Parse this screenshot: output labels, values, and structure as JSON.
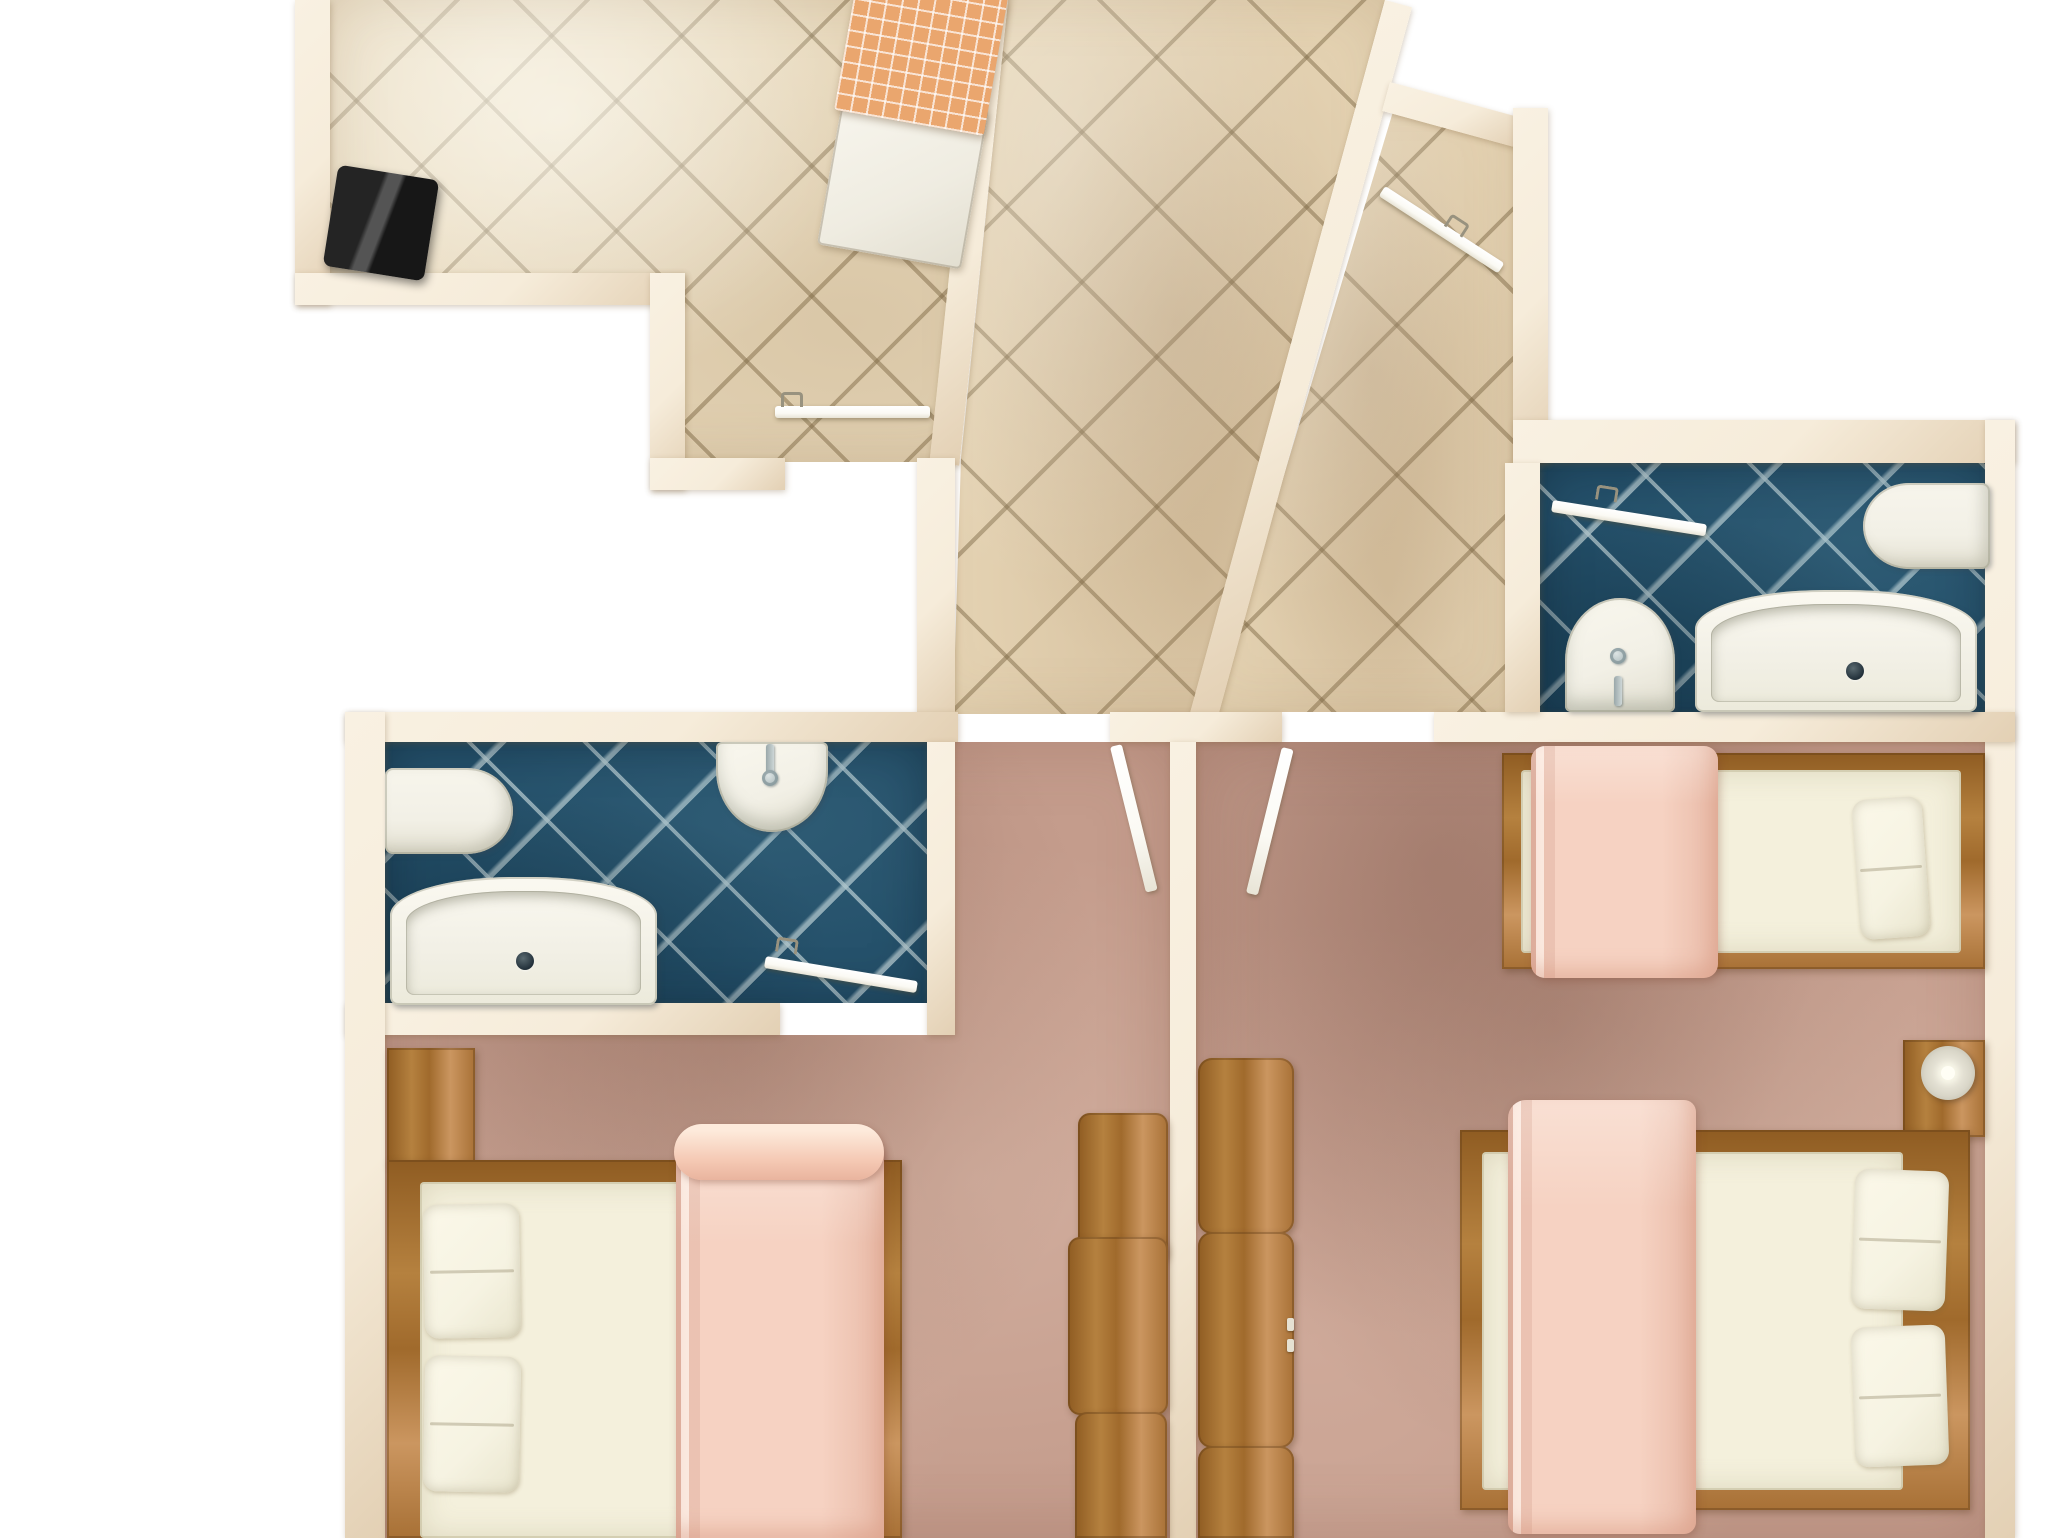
{
  "title": "apartment-floor-plan-top-view",
  "colors": {
    "background": "#ffffff",
    "wall": "#f6ecda",
    "wallEdge": "#e3d0b4",
    "tileBeige": "#e6d6b8",
    "tileLarge": "#e4d2b2",
    "tealTile": "#24506a",
    "carpet": "#c49c8c",
    "wood": "#b5813f",
    "woodDark": "#8f5c22",
    "woodLight": "#cb9660",
    "fixture": "#f2f0e6",
    "mattress": "#f4f0dc",
    "pillow": "#f6f3e2",
    "blanket": "#f6d2c2",
    "blanketDeep": "#e9b49e",
    "doorWhite": "#fbfaf4",
    "lamp": "#d9d6c8",
    "orange": "#eaa66e",
    "black": "#171717"
  },
  "rooms": [
    {
      "name": "dining-room",
      "floor": "beige-diagonal-tile"
    },
    {
      "name": "hallway",
      "floor": "beige-diagonal-tile-large"
    },
    {
      "name": "entry-branch",
      "floor": "beige-diagonal-tile-large"
    },
    {
      "name": "bathroom-left",
      "floor": "teal-diagonal-tile"
    },
    {
      "name": "bathroom-right",
      "floor": "teal-diagonal-tile"
    },
    {
      "name": "bedroom-left",
      "floor": "rose-carpet"
    },
    {
      "name": "bedroom-right",
      "floor": "rose-carpet"
    }
  ],
  "scene": [
    {
      "n": "floor-dining-room",
      "k": "tilesS",
      "x": 330,
      "y": 0,
      "w": 650,
      "h": 462,
      "clip": "polygon(0px 0px, 648px 0px, 600px 462px, 320px 462px, 320px 273px, 0px 273px)"
    },
    {
      "n": "dining-room-light",
      "k": "shadeLight",
      "x": 330,
      "y": 0,
      "w": 650,
      "h": 462,
      "clip": "polygon(0px 0px, 648px 0px, 600px 462px, 320px 462px, 320px 273px, 0px 273px)"
    },
    {
      "n": "floor-hallway",
      "k": "tilesL",
      "x": 917,
      "y": 0,
      "w": 470,
      "h": 714,
      "clip": "polygon(91px 0px, 468px 0px, 273px 714px, 36px 714px, 44px 458px)"
    },
    {
      "n": "hallway-shade",
      "k": "shadeWarm",
      "x": 917,
      "y": 0,
      "w": 470,
      "h": 714,
      "clip": "polygon(91px 0px, 468px 0px, 273px 714px, 36px 714px, 44px 458px)"
    },
    {
      "n": "floor-entry-branch",
      "k": "tilesL",
      "x": 1190,
      "y": 85,
      "w": 330,
      "h": 630,
      "clip": "polygon(208px 10px, 330px 43px, 325px 627px, 23px 627px)"
    },
    {
      "n": "entry-branch-shade",
      "k": "shadeWarm",
      "x": 1190,
      "y": 85,
      "w": 330,
      "h": 630,
      "clip": "polygon(208px 10px, 330px 43px, 325px 627px, 23px 627px)"
    },
    {
      "n": "floor-bathroom-right",
      "k": "tilesT",
      "x": 1540,
      "y": 463,
      "w": 450,
      "h": 252
    },
    {
      "n": "floor-bathroom-left",
      "k": "tilesT",
      "x": 385,
      "y": 742,
      "w": 542,
      "h": 261
    },
    {
      "n": "floor-bedroom-left",
      "k": "carpet",
      "x": 385,
      "y": 742,
      "w": 785,
      "h": 796,
      "clip": "polygon(570px 0px, 785px 0px, 785px 796px, 0px 796px, 0px 293px, 570px 293px)"
    },
    {
      "n": "bedroom-left-shade",
      "k": "shadeDark",
      "x": 385,
      "y": 742,
      "w": 785,
      "h": 796,
      "clip": "polygon(570px 0px, 785px 0px, 785px 796px, 0px 796px, 0px 293px, 570px 293px)"
    },
    {
      "n": "floor-bedroom-right",
      "k": "carpet",
      "x": 1196,
      "y": 742,
      "w": 794,
      "h": 796
    },
    {
      "n": "bedroom-right-shade",
      "k": "shadeDark",
      "x": 1196,
      "y": 742,
      "w": 794,
      "h": 796
    },
    {
      "n": "wall-dining-left",
      "k": "wall",
      "x": 295,
      "y": 0,
      "w": 35,
      "h": 305
    },
    {
      "n": "wall-dining-bottom",
      "k": "wall",
      "x": 295,
      "y": 273,
      "w": 390,
      "h": 32
    },
    {
      "n": "wall-dining-step",
      "k": "wall",
      "x": 650,
      "y": 273,
      "w": 35,
      "h": 217
    },
    {
      "n": "wall-dining-bottom-2",
      "k": "wall",
      "x": 650,
      "y": 458,
      "w": 135,
      "h": 32
    },
    {
      "n": "wall-dining-right",
      "k": "wall",
      "x": 978,
      "y": 0,
      "w": 30,
      "h": 465,
      "r": 6,
      "o": "0 0"
    },
    {
      "n": "wall-hallway-right",
      "k": "wall",
      "x": 1385,
      "y": 0,
      "w": 28,
      "h": 738,
      "r": 15.3,
      "o": "0 0"
    },
    {
      "n": "wall-entry-top",
      "k": "wall",
      "x": 1390,
      "y": 82,
      "w": 140,
      "h": 30,
      "r": 15.3,
      "o": "0 0"
    },
    {
      "n": "wall-entry-right",
      "k": "wall",
      "x": 1513,
      "y": 108,
      "w": 35,
      "h": 355
    },
    {
      "n": "wall-bathroom-right-top",
      "k": "wall",
      "x": 1513,
      "y": 420,
      "w": 502,
      "h": 43
    },
    {
      "n": "wall-outer-right",
      "k": "wall",
      "x": 1985,
      "y": 420,
      "w": 30,
      "h": 1118
    },
    {
      "n": "wall-hallway-left-strip",
      "k": "wall",
      "x": 917,
      "y": 458,
      "w": 38,
      "h": 256
    },
    {
      "n": "wall-main-a",
      "k": "wall",
      "x": 345,
      "y": 712,
      "w": 613,
      "h": 30
    },
    {
      "n": "wall-main-b",
      "k": "wall",
      "x": 1110,
      "y": 712,
      "w": 172,
      "h": 30
    },
    {
      "n": "wall-main-c",
      "k": "wall",
      "x": 1434,
      "y": 712,
      "w": 581,
      "h": 30
    },
    {
      "n": "wall-center-divider",
      "k": "wall",
      "x": 1170,
      "y": 742,
      "w": 26,
      "h": 796
    },
    {
      "n": "wall-bathroom-left-right",
      "k": "wall",
      "x": 927,
      "y": 742,
      "w": 28,
      "h": 293
    },
    {
      "n": "wall-bathroom-left-bottom",
      "k": "wall",
      "x": 345,
      "y": 1003,
      "w": 435,
      "h": 32
    },
    {
      "n": "wall-outer-left",
      "k": "wall",
      "x": 345,
      "y": 712,
      "w": 40,
      "h": 826
    },
    {
      "n": "wall-bathroom-right-left",
      "k": "wall",
      "x": 1505,
      "y": 463,
      "w": 35,
      "h": 249
    },
    {
      "n": "toilet-left-bathroom",
      "k": "fixture",
      "x": 385,
      "y": 768,
      "w": 128,
      "h": 86,
      "rad": "8px 46px 46px 8px / 8px 43px 43px 8px"
    },
    {
      "n": "sink-left-bathroom",
      "k": "sink",
      "x": 716,
      "y": 742,
      "w": 112,
      "h": 90,
      "rad": "6px 6px 56px 56px / 6px 6px 62px 62px"
    },
    {
      "n": "faucet-stem-left",
      "k": "stem",
      "x": 766,
      "y": 744,
      "w": 8,
      "h": 30
    },
    {
      "n": "faucet-knob-left",
      "k": "knob",
      "x": 762,
      "y": 770,
      "w": 16,
      "h": 16
    },
    {
      "n": "bathtub-left",
      "k": "tub",
      "x": 390,
      "y": 877,
      "w": 267,
      "h": 128,
      "rad": "46% 46% 8px 8px / 30% 30% 8px 8px"
    },
    {
      "n": "drain-left",
      "k": "drain",
      "x": 516,
      "y": 952,
      "w": 18,
      "h": 18
    },
    {
      "n": "toilet-right-bathroom",
      "k": "fixture",
      "x": 1863,
      "y": 483,
      "w": 127,
      "h": 86,
      "rad": "46px 8px 8px 46px / 43px 8px 8px 43px"
    },
    {
      "n": "sink-right-bathroom",
      "k": "sink",
      "x": 1565,
      "y": 598,
      "w": 110,
      "h": 114,
      "rad": "56px 56px 6px 6px / 64px 64px 6px 6px"
    },
    {
      "n": "faucet-stem-right",
      "k": "stem",
      "x": 1614,
      "y": 676,
      "w": 8,
      "h": 30
    },
    {
      "n": "faucet-knob-right",
      "k": "knob",
      "x": 1610,
      "y": 648,
      "w": 16,
      "h": 16
    },
    {
      "n": "bathtub-right",
      "k": "tub",
      "x": 1695,
      "y": 590,
      "w": 282,
      "h": 122,
      "rad": "46% 46% 8px 8px / 32% 32% 8px 8px"
    },
    {
      "n": "drain-right",
      "k": "drain",
      "x": 1846,
      "y": 662,
      "w": 18,
      "h": 18
    },
    {
      "n": "dark-cabinet",
      "k": "blackbox",
      "x": 330,
      "y": 172,
      "w": 102,
      "h": 102,
      "r": 9
    },
    {
      "n": "dining-chair",
      "k": "chair",
      "x": 830,
      "y": 96,
      "w": 146,
      "h": 162,
      "r": 10
    },
    {
      "n": "dining-table",
      "k": "tablecloth",
      "x": 846,
      "y": -28,
      "w": 152,
      "h": 152,
      "r": 10
    },
    {
      "n": "bedside-table-left",
      "k": "wood",
      "x": 387,
      "y": 1048,
      "w": 88,
      "h": 117
    },
    {
      "n": "bed-left-frame",
      "k": "woodh",
      "x": 387,
      "y": 1160,
      "w": 515,
      "h": 378
    },
    {
      "n": "bed-left-mattress",
      "k": "mattress",
      "x": 420,
      "y": 1182,
      "w": 462,
      "h": 356
    },
    {
      "n": "bed-left-pillow-top",
      "k": "pillow",
      "x": 424,
      "y": 1204,
      "w": 96,
      "h": 134,
      "r": -1
    },
    {
      "n": "bed-left-pillow-bottom",
      "k": "pillow",
      "x": 424,
      "y": 1356,
      "w": 96,
      "h": 136,
      "r": 1
    },
    {
      "n": "bed-left-blanket",
      "k": "blanket",
      "x": 676,
      "y": 1146,
      "w": 208,
      "h": 392,
      "rad": "16px 10px 0 0"
    },
    {
      "n": "bed-left-blanket-roll",
      "k": "roll",
      "x": 674,
      "y": 1124,
      "w": 210,
      "h": 56
    },
    {
      "n": "dresser-left-1",
      "k": "wood",
      "x": 1078,
      "y": 1113,
      "w": 90,
      "h": 150,
      "rad": "12px"
    },
    {
      "n": "dresser-left-2",
      "k": "wood",
      "x": 1068,
      "y": 1237,
      "w": 100,
      "h": 178,
      "rad": "12px"
    },
    {
      "n": "dresser-left-3",
      "k": "wood",
      "x": 1075,
      "y": 1412,
      "w": 92,
      "h": 126,
      "rad": "12px 12px 0 0"
    },
    {
      "n": "dresser-right-1",
      "k": "wood",
      "x": 1198,
      "y": 1058,
      "w": 96,
      "h": 176,
      "rad": "14px"
    },
    {
      "n": "dresser-right-2",
      "k": "wood",
      "x": 1198,
      "y": 1232,
      "w": 96,
      "h": 216,
      "rad": "14px"
    },
    {
      "n": "dresser-right-handle-a",
      "k": "handle",
      "x": 1287,
      "y": 1318,
      "w": 7,
      "h": 13
    },
    {
      "n": "dresser-right-handle-b",
      "k": "handle",
      "x": 1287,
      "y": 1339,
      "w": 7,
      "h": 13
    },
    {
      "n": "dresser-right-3",
      "k": "wood",
      "x": 1198,
      "y": 1446,
      "w": 96,
      "h": 92,
      "rad": "14px 14px 0 0"
    },
    {
      "n": "bed-right-single-frame",
      "k": "woodh",
      "x": 1502,
      "y": 753,
      "w": 483,
      "h": 216
    },
    {
      "n": "bed-right-single-mattress",
      "k": "mattress",
      "x": 1521,
      "y": 770,
      "w": 440,
      "h": 183
    },
    {
      "n": "bed-right-single-pillow",
      "k": "pillow",
      "x": 1856,
      "y": 798,
      "w": 70,
      "h": 140,
      "r": -4
    },
    {
      "n": "bed-right-single-blanket",
      "k": "blanket",
      "x": 1531,
      "y": 746,
      "w": 187,
      "h": 232,
      "rad": "14px"
    },
    {
      "n": "nightstand-right",
      "k": "wood",
      "x": 1903,
      "y": 1040,
      "w": 82,
      "h": 97
    },
    {
      "n": "lamp-base",
      "k": "lampOuter",
      "x": 1921,
      "y": 1046,
      "w": 54,
      "h": 54
    },
    {
      "n": "lamp-bulb",
      "k": "lampInner",
      "x": 1941,
      "y": 1066,
      "w": 14,
      "h": 14
    },
    {
      "n": "bed-right-double-frame",
      "k": "woodh",
      "x": 1460,
      "y": 1130,
      "w": 510,
      "h": 380
    },
    {
      "n": "bed-right-double-mattress",
      "k": "mattress",
      "x": 1482,
      "y": 1152,
      "w": 421,
      "h": 338
    },
    {
      "n": "bed-right-double-pillow-top",
      "k": "pillow",
      "x": 1853,
      "y": 1170,
      "w": 94,
      "h": 140,
      "r": 2
    },
    {
      "n": "bed-right-double-pillow-bottom",
      "k": "pillow",
      "x": 1853,
      "y": 1326,
      "w": 94,
      "h": 140,
      "r": -2
    },
    {
      "n": "bed-right-double-blanket",
      "k": "blanket",
      "x": 1508,
      "y": 1100,
      "w": 188,
      "h": 434,
      "rad": "18px 12px 12px 12px"
    },
    {
      "n": "door-dining",
      "k": "doorbar",
      "x": 775,
      "y": 406,
      "w": 155,
      "h": 12
    },
    {
      "n": "door-dining-handle",
      "k": "hook",
      "x": 781,
      "y": 392,
      "w": 22,
      "h": 15
    },
    {
      "n": "door-entry",
      "k": "doorbar",
      "x": 1382,
      "y": 185,
      "w": 142,
      "h": 12,
      "r": 33,
      "o": "0 50%"
    },
    {
      "n": "door-entry-handle",
      "k": "hook",
      "x": 1446,
      "y": 218,
      "w": 22,
      "h": 15,
      "r": 33
    },
    {
      "n": "door-bathroom-right",
      "k": "doorbar",
      "x": 1552,
      "y": 500,
      "w": 156,
      "h": 12,
      "r": 9,
      "o": "0 50%"
    },
    {
      "n": "door-bathroom-right-handle",
      "k": "hook",
      "x": 1596,
      "y": 486,
      "w": 22,
      "h": 15,
      "r": 9
    },
    {
      "n": "door-bedroom-left",
      "k": "doorbar",
      "x": 1110,
      "y": 747,
      "w": 12,
      "h": 150,
      "r": -13.9,
      "o": "0 0"
    },
    {
      "n": "door-bedroom-right",
      "k": "doorbar",
      "x": 1282,
      "y": 747,
      "w": 12,
      "h": 150,
      "r": 13.9,
      "o": "0 0"
    },
    {
      "n": "door-bathroom-left",
      "k": "doorbar",
      "x": 765,
      "y": 956,
      "w": 154,
      "h": 12,
      "r": 9.4,
      "o": "0 50%"
    },
    {
      "n": "door-bathroom-left-handle",
      "k": "hook",
      "x": 776,
      "y": 938,
      "w": 22,
      "h": 15,
      "r": 9
    }
  ]
}
